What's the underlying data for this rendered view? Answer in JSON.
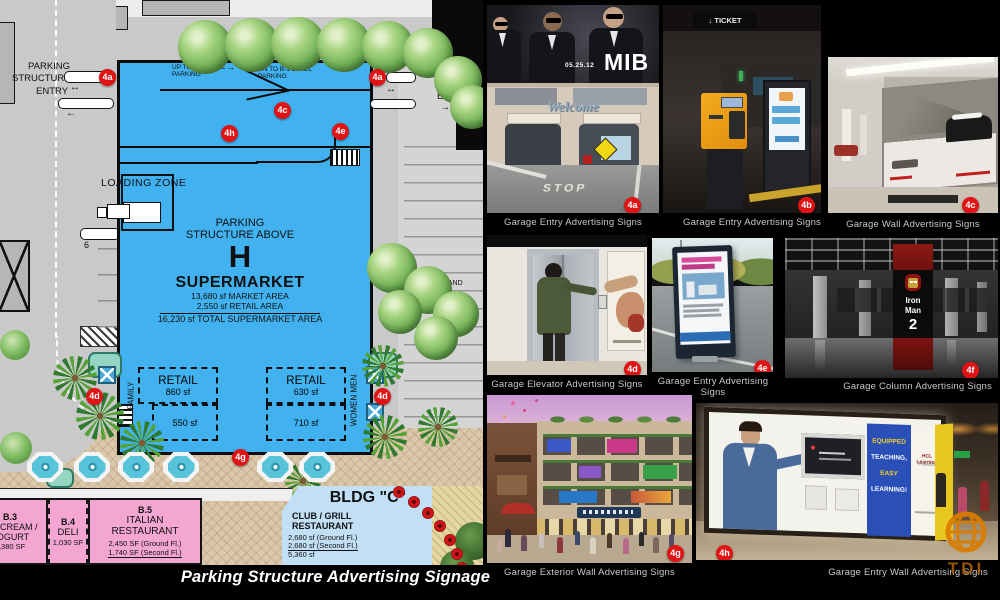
{
  "plan": {
    "entry_left": [
      "PARKING",
      "STRUCTURE",
      "ENTRY"
    ],
    "entry_right": [
      "PARKING",
      "STRUCTURE",
      "ENTRY"
    ],
    "ramp_up": [
      "UP TO P-3 LEVEL",
      "PARKING"
    ],
    "ramp_down": [
      "DN TO B-1 LEVEL",
      "PARKING"
    ],
    "loading_zone": "LOADING ZONE",
    "structure_label1": "PARKING",
    "structure_label2": "STRUCTURE ABOVE",
    "structure_letter": "H",
    "supermarket": "SUPERMARKET",
    "market_area": "13,680 sf  MARKET AREA",
    "retail_area": "2,550 sf  RETAIL AREA",
    "total_area": "16,230 sf  TOTAL SUPERMARKET AREA",
    "retail_left": {
      "label": "RETAIL",
      "area": "860 sf",
      "area_lower": "550 sf"
    },
    "retail_right": {
      "label": "RETAIL",
      "area": "630 sf",
      "area_lower": "710 sf"
    },
    "family": "FAMILY",
    "women_men": "WOMEN MEN",
    "stall_6": "6",
    "stall_17": "17",
    "land": "LAND",
    "bldg_c": {
      "title": "BLDG \"C\"",
      "line1": "CLUB / GRILL",
      "line2": "RESTAURANT",
      "area1": "2,680 sf (Ground Fl.)",
      "area2": "2,680 sf (Second Fl.)",
      "total": "5,360 sf"
    },
    "b3": {
      "id": "B.3",
      "line1": "ICE CREAM /",
      "line2": "YOGURT",
      "area": "1,380 SF"
    },
    "b4": {
      "id": "B.4",
      "line1": "DELI",
      "area": "1,030 SF"
    },
    "b5": {
      "id": "B.5",
      "line1": "ITALIAN",
      "line2": "RESTAURANT",
      "area1": "2,450 SF (Ground Fl.)",
      "area2": "1,740 SF (Second Fl.)"
    },
    "badges": [
      "4a",
      "4a",
      "4c",
      "4h",
      "4e",
      "4d",
      "4d",
      "4g"
    ]
  },
  "photos": [
    {
      "id": "4a",
      "caption": "Garage Entry Advertising Signs",
      "overlay": {
        "date": "05.25.12",
        "title": "MIB",
        "welcome": "Welcome",
        "stop": "STOP"
      }
    },
    {
      "id": "4b",
      "caption": "Garage Entry Advertising Signs",
      "overlay": {
        "sign": "TICKET"
      }
    },
    {
      "id": "4c",
      "caption": "Garage Wall Advertising Signs",
      "overlay": {}
    },
    {
      "id": "4d",
      "caption": "Garage Elevator Advertising Signs",
      "overlay": {}
    },
    {
      "id": "4e",
      "caption": "Garage Entry Advertising Signs",
      "overlay": {}
    },
    {
      "id": "4f",
      "caption": "Garage Column Advertising Signs",
      "overlay": {
        "line1": "Iron",
        "line2": "Man",
        "line3": "2"
      }
    },
    {
      "id": "4g",
      "caption": "Garage Exterior Wall Advertising Signs",
      "overlay": {}
    },
    {
      "id": "4h",
      "caption": "Garage Entry Wall Advertising Signs",
      "overlay": {
        "ad1": "EQUIPPED",
        "ad2": "TEACHING,",
        "ad3": "EASY",
        "ad4": "LEARNING!",
        "brand": "HCL Learning",
        "brand2": "Presents"
      }
    }
  ],
  "footer": {
    "caption": "Parking Structure Advertising Signage"
  },
  "logo": {
    "text": "TDI"
  },
  "colors": {
    "badge_red": "#e01414",
    "plan_blue": "#41b2ef",
    "caption_gray": "#c9c9c9",
    "tdi_orange": "#d97c00"
  }
}
